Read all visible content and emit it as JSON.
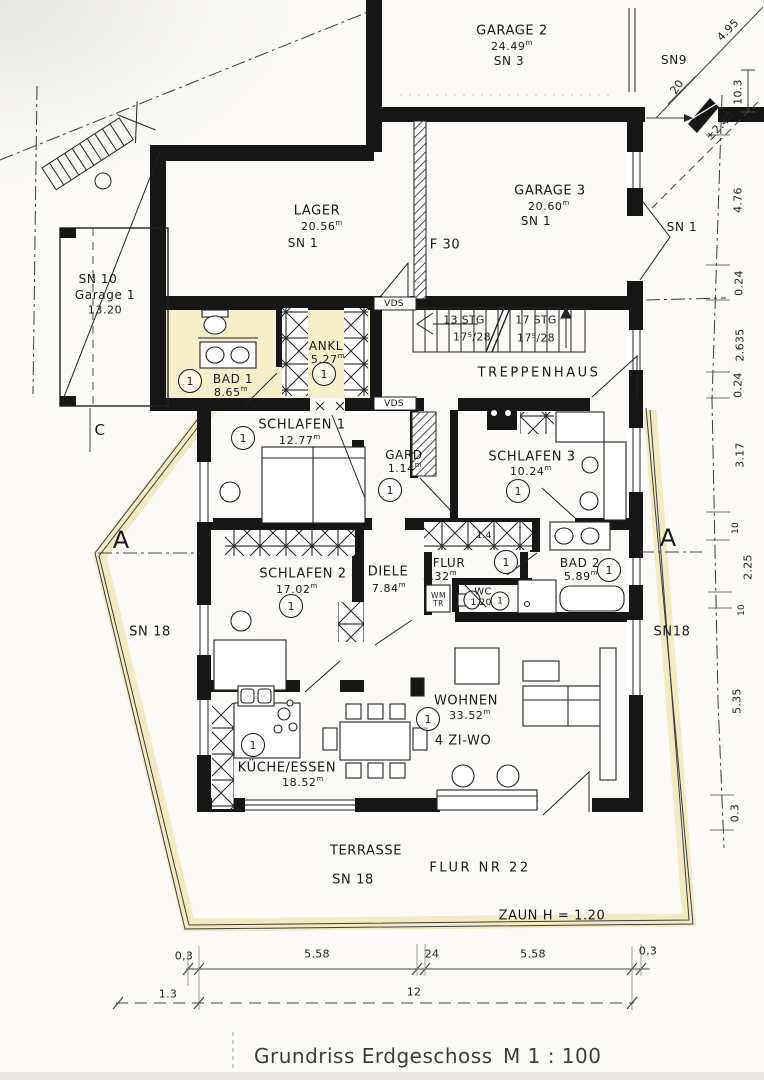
{
  "document": {
    "title": "Grundriss Erdgeschoss",
    "scale": "M 1 : 100"
  },
  "rooms": {
    "garage2": {
      "name": "GARAGE 2",
      "area": "24.49",
      "sn": "SN 3"
    },
    "lager": {
      "name": "LAGER",
      "area": "20.56",
      "sn": "SN 1"
    },
    "garage3": {
      "name": "GARAGE 3",
      "area": "20.60",
      "sn": "SN 1"
    },
    "garage1": {
      "sn": "SN 10",
      "name": "Garage 1",
      "area": "13.20"
    },
    "bad1": {
      "name": "BAD 1",
      "area": "8.65"
    },
    "ankl": {
      "name": "ANKL",
      "area": "5.27"
    },
    "treppenhaus": {
      "name": "TREPPENHAUS"
    },
    "schlafen1": {
      "name": "SCHLAFEN 1",
      "area": "12.77"
    },
    "gard": {
      "name": "GARD",
      "area": "1.14"
    },
    "schlafen3": {
      "name": "SCHLAFEN 3",
      "area": "10.24"
    },
    "schlafen2": {
      "name": "SCHLAFEN 2",
      "area": "17.02"
    },
    "diele": {
      "name": "DIELE",
      "area": "7.84"
    },
    "flur": {
      "name": "FLUR",
      "area": "3.32"
    },
    "wc": {
      "name": "WC",
      "area": "1.20"
    },
    "bad2": {
      "name": "BAD 2",
      "area": "5.89"
    },
    "wohnen": {
      "name": "WOHNEN",
      "area": "33.52",
      "type": "4 ZI-WO"
    },
    "kueche": {
      "name": "KÜCHE/ESSEN",
      "area": "18.52"
    },
    "terrasse": {
      "name": "TERRASSE",
      "sn": "SN 18"
    }
  },
  "stairs": {
    "flight1": "13 STG",
    "flight1_step": "17⁵/28",
    "flight2": "17 STG",
    "flight2_step": "17⁵/28"
  },
  "annotations": {
    "sn9": "SN9",
    "sn1_right": "SN 1",
    "f30": "F 30",
    "vds": "VDS",
    "sn18_left": "SN 18",
    "sn18_right": "SN18",
    "flur_nr": "FLUR NR 22",
    "zaun": "ZAUN H = 1.20",
    "section_a": "A",
    "section_c": "C",
    "unit_circle": "1",
    "wm": "WM",
    "tr": "TR",
    "wardrobe_width": "1.4",
    "sup": "m"
  },
  "dimensions": {
    "top_right": {
      "d1": "4.95",
      "d2": "20",
      "d3": "10.3",
      "d4": "±2.40"
    },
    "right_chain": [
      "4.76",
      "0.24",
      "2.635",
      "0.24",
      "3.17",
      "10",
      "2.25",
      "10",
      "5.35",
      "0.3"
    ],
    "bottom_row1": [
      "0,3",
      "5.58",
      "24",
      "5.58",
      "0,3"
    ],
    "bottom_row2": [
      "1.3",
      "12"
    ]
  }
}
